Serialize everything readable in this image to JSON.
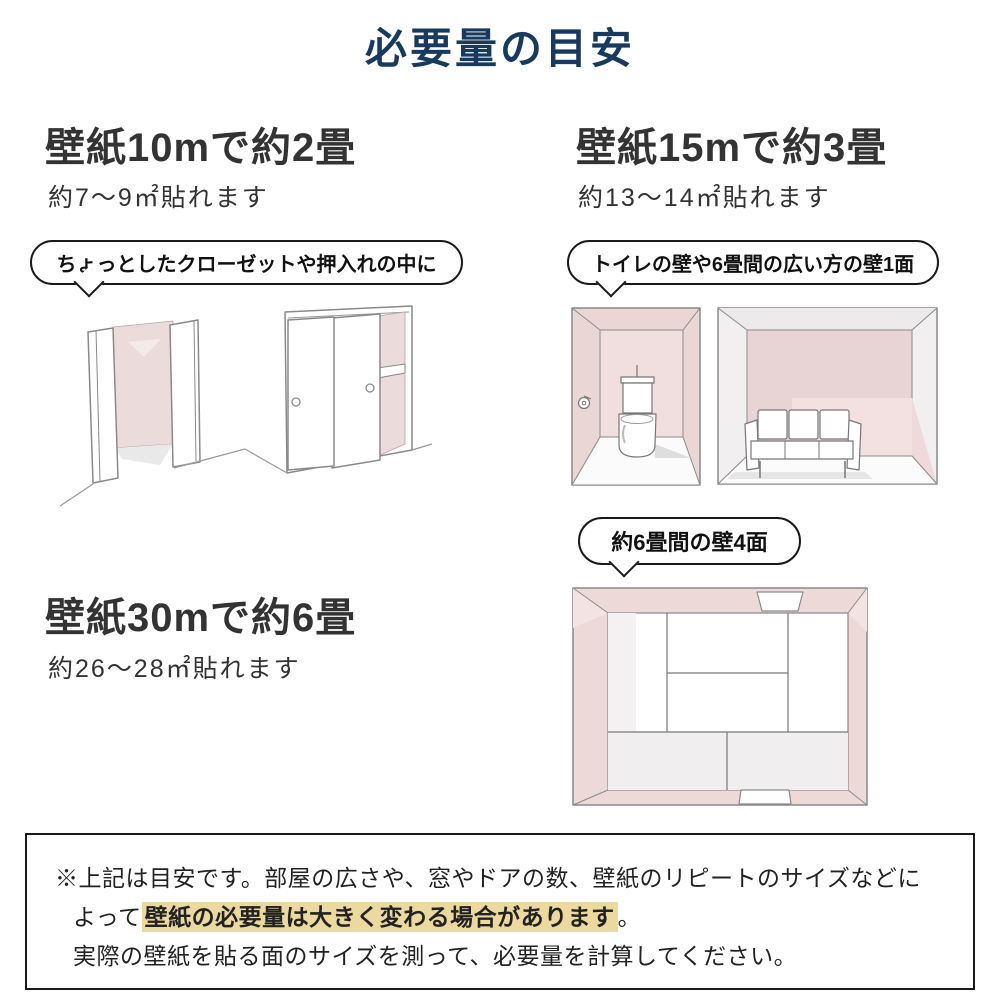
{
  "title": "必要量の目安",
  "sections": {
    "ten": {
      "heading": "壁紙10mで約2畳",
      "subtitle": "約7〜9㎡貼れます",
      "bubble": "ちょっとしたクローゼットや押入れの中に"
    },
    "fifteen": {
      "heading": "壁紙15mで約3畳",
      "subtitle": "約13〜14㎡貼れます",
      "bubble": "トイレの壁や6畳間の広い方の壁1面"
    },
    "thirty": {
      "heading": "壁紙30mで約6畳",
      "subtitle": "約26〜28㎡貼れます",
      "bubble": "約6畳間の壁4面"
    }
  },
  "note": {
    "line1": "※上記は目安です。部屋の広さや、窓やドアの数、壁紙のリピートのサイズなどに",
    "line2_prefix": "よって",
    "line2_highlight": "壁紙の必要量は大きく変わる場合があります",
    "line2_suffix": "。",
    "line3": "実際の壁紙を貼る面のサイズを測って、必要量を計算してください。"
  },
  "colors": {
    "title_navy": "#183a5e",
    "heading_gray": "#333333",
    "wall_pink": "#ecd9d9",
    "highlight_yellow": "#ecd9a0",
    "sketch_line_gray": "#8a8a8a"
  },
  "illustrations": [
    "closet-open-doors",
    "oshiire-sliding-doors",
    "toilet-room",
    "six-tatami-living-room",
    "six-tatami-room-top-view"
  ]
}
